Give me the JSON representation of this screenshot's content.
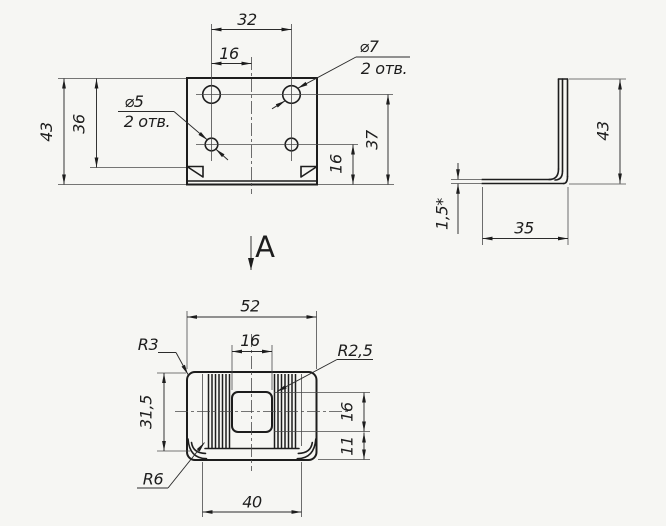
{
  "drawing_background": "#f6f6f3",
  "ink_color": "#1d1d1d",
  "front_view": {
    "dim_hole_spacing": "32",
    "dim_hole_to_center": "16",
    "dim_height": "43",
    "dim_to_bend": "36",
    "dim_top_holes_to_bottom": "37",
    "dim_bottom_holes_to_bottom": "16",
    "small_holes": {
      "dia": "⌀5",
      "qty": "2 отв."
    },
    "large_holes": {
      "dia": "⌀7",
      "qty": "2 отв."
    }
  },
  "side_view": {
    "dim_height": "43",
    "dim_flange_depth": "35",
    "dim_thickness": "1,5*"
  },
  "view_marker": {
    "label": "А"
  },
  "bottom_view": {
    "dim_width": "52",
    "dim_opening_width": "16",
    "dim_depth": "31,5",
    "dim_opening_height": "16",
    "dim_edge_to_opening": "11",
    "dim_flange_width": "40",
    "radius_corner": "R3",
    "radius_opening": "R2,5",
    "radius_bend": "R6"
  }
}
